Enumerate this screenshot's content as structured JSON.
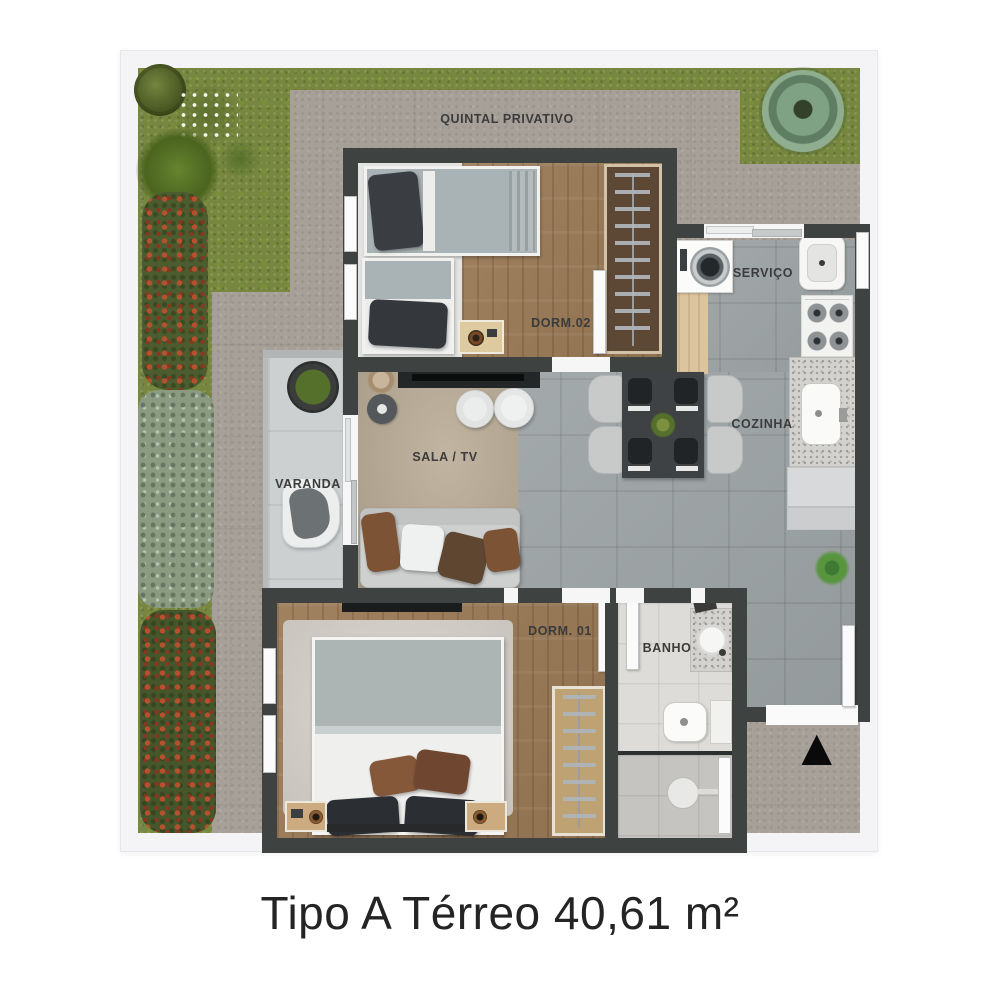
{
  "title": "Tipo A Térreo 40,61 m²",
  "rooms": {
    "quintal": "QUINTAL PRIVATIVO",
    "dorm2": "DORM.02",
    "servico": "SERVIÇO",
    "cozinha": "COZINHA",
    "sala": "SALA / TV",
    "varanda": "VARANDA",
    "dorm1": "DORM. 01",
    "banho": "BANHO"
  },
  "markers": {
    "entrance_glyph": "▲"
  },
  "colors": {
    "wall": "#3e4241",
    "grass": "#78873f",
    "concrete_path": "#a7a098",
    "tile_floor": "#9da4a6",
    "wood_floor": "#9b7b57",
    "rug_sala": "#b3a793",
    "frame": "#f4f4f6",
    "flower_red": "#b1502f",
    "hedge_silver": "#90a087",
    "entrance_marker": "#0a0a0a"
  }
}
